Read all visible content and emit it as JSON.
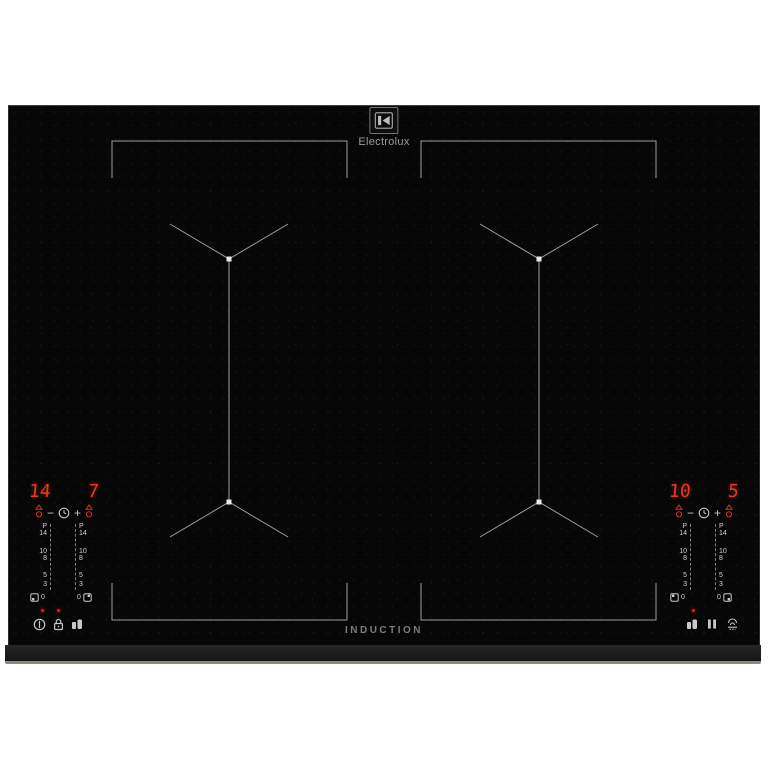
{
  "brand": {
    "name": "Electrolux"
  },
  "hob": {
    "induction_label": "INDUCTION",
    "slider_scale": [
      "P",
      "14",
      "10",
      "8",
      "5",
      "3",
      "0"
    ],
    "left_panel": {
      "zone1_level": "14",
      "zone2_level": "7",
      "minus": "−",
      "plus": "+",
      "indicator_leds": 2,
      "buttons": [
        "power-icon",
        "lock-icon",
        "bridge-icon"
      ]
    },
    "right_panel": {
      "zone1_level": "10",
      "zone2_level": "5",
      "minus": "−",
      "plus": "+",
      "indicator_leds": 1,
      "buttons": [
        "bridge-icon",
        "pause-icon",
        "hob2hood-icon"
      ]
    },
    "timer_icons": [
      "minute-minder-icon",
      "timer-indicator-icon",
      "minus-key",
      "clock-icon",
      "plus-key"
    ],
    "zones": [
      "flexible-zone-left",
      "flexible-zone-right"
    ]
  },
  "colors": {
    "red": "#e63a1c",
    "led": "#e02408",
    "glass": "#070707",
    "frame": "#1c1c1c",
    "edge": "#8e8878",
    "line": "#b9b9b9",
    "label": "#d4d4d4",
    "icon": "#c8c8c8"
  }
}
